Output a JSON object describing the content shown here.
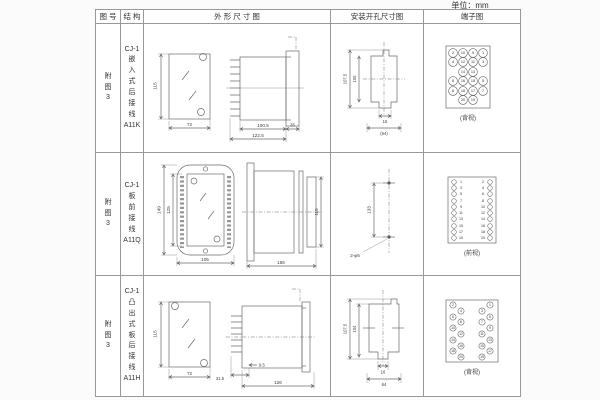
{
  "unit_label": "单位：mm",
  "headers": {
    "fig_no": "图 号",
    "structure": "结 构",
    "outline": "外 形 尺 寸 图",
    "mounting": "安装开孔尺寸图",
    "terminal": "端子图"
  },
  "rows": [
    {
      "fig_no": "附\n图\n3",
      "structure": "CJ-1\n嵌\n入\n式\n后\n接\n线\nA11K",
      "outline": {
        "front_h": "115",
        "front_w": "72",
        "side_inner": "100.5",
        "side_total": "122.5",
        "side_flange": "35"
      },
      "mounting": {
        "outer": "107.5",
        "inner": "105",
        "slot": "16",
        "span": "(64)"
      },
      "terminal": {
        "view_label": "(背视)",
        "items": [
          [
            29,
            29,
            "2"
          ],
          [
            39,
            29,
            "10"
          ],
          [
            49,
            29,
            "9"
          ],
          [
            59,
            29,
            "1"
          ],
          [
            29,
            38,
            "4"
          ],
          [
            39,
            38,
            "12"
          ],
          [
            49,
            38,
            "11"
          ],
          [
            59,
            38,
            "3"
          ],
          [
            39,
            48,
            "14"
          ],
          [
            49,
            48,
            "13"
          ],
          [
            29,
            57,
            "6"
          ],
          [
            39,
            57,
            "16"
          ],
          [
            49,
            57,
            "15"
          ],
          [
            59,
            57,
            "5"
          ],
          [
            29,
            67,
            "8"
          ],
          [
            39,
            67,
            "18"
          ],
          [
            49,
            67,
            "17"
          ],
          [
            59,
            67,
            "7"
          ],
          [
            39,
            76,
            "20"
          ],
          [
            49,
            76,
            "19"
          ]
        ]
      }
    },
    {
      "fig_no": "附\n图\n3",
      "structure": "CJ-1\n板\n前\n接\n线\nA11Q",
      "outline": {
        "front_h_outer": "149",
        "front_h_inner": "125",
        "front_w": "105",
        "side_len": "156",
        "side_h": "115"
      },
      "mounting": {
        "span": "133",
        "holes": "2-φ6"
      },
      "terminal": {
        "view_label": "(前视)",
        "items": [
          [
            30,
            29,
            "",
            "o"
          ],
          [
            37,
            29,
            "1",
            "t"
          ],
          [
            59,
            29,
            "2",
            "t"
          ],
          [
            66,
            29,
            "",
            "o"
          ],
          [
            30,
            35,
            "",
            "o"
          ],
          [
            37,
            35,
            "3",
            "t"
          ],
          [
            59,
            35,
            "4",
            "t"
          ],
          [
            66,
            35,
            "",
            "o"
          ],
          [
            30,
            41,
            "",
            "o"
          ],
          [
            37,
            41,
            "5",
            "t"
          ],
          [
            59,
            41,
            "6",
            "t"
          ],
          [
            66,
            41,
            "",
            "o"
          ],
          [
            30,
            48,
            "",
            "o"
          ],
          [
            37,
            48,
            "7",
            "t"
          ],
          [
            59,
            48,
            "8",
            "t"
          ],
          [
            66,
            48,
            "",
            "o"
          ],
          [
            30,
            54,
            "",
            "o"
          ],
          [
            37,
            54,
            "9",
            "t"
          ],
          [
            59,
            54,
            "10",
            "t"
          ],
          [
            66,
            54,
            "",
            "o"
          ],
          [
            30,
            60,
            "",
            "o"
          ],
          [
            37,
            60,
            "11",
            "t"
          ],
          [
            59,
            60,
            "12",
            "t"
          ],
          [
            66,
            60,
            "",
            "o"
          ],
          [
            30,
            66,
            "",
            "o"
          ],
          [
            37,
            66,
            "13",
            "t"
          ],
          [
            59,
            66,
            "14",
            "t"
          ],
          [
            66,
            66,
            "",
            "o"
          ],
          [
            30,
            73,
            "",
            "o"
          ],
          [
            37,
            73,
            "15",
            "t"
          ],
          [
            59,
            73,
            "16",
            "t"
          ],
          [
            66,
            73,
            "",
            "o"
          ],
          [
            30,
            79,
            "",
            "o"
          ],
          [
            37,
            79,
            "17",
            "t"
          ],
          [
            59,
            79,
            "18",
            "t"
          ],
          [
            66,
            79,
            "",
            "o"
          ],
          [
            30,
            85,
            "",
            "o"
          ],
          [
            37,
            85,
            "19",
            "t"
          ],
          [
            59,
            85,
            "20",
            "t"
          ],
          [
            66,
            85,
            "",
            "o"
          ]
        ]
      }
    },
    {
      "fig_no": "附\n图\n3",
      "structure": "CJ-1\n凸\n出\n式\n板\n后\n接\n线\nA11H",
      "outline": {
        "front_h": "115",
        "front_w": "72",
        "fin_w": "31.5",
        "gap": "9.5",
        "side_len": "126"
      },
      "mounting": {
        "outer": "107.5",
        "inner": "104",
        "slot": "16",
        "span": "64"
      },
      "terminal": {
        "view_label": "(背视)",
        "items": [
          [
            29,
            29,
            "2"
          ],
          [
            66,
            29,
            "1"
          ],
          [
            37,
            35,
            "4"
          ],
          [
            58,
            35,
            "3"
          ],
          [
            29,
            41,
            "6"
          ],
          [
            66,
            41,
            "5"
          ],
          [
            37,
            46,
            "8"
          ],
          [
            58,
            46,
            "7"
          ],
          [
            29,
            52,
            "10"
          ],
          [
            66,
            52,
            "9"
          ],
          [
            37,
            58,
            "12"
          ],
          [
            58,
            58,
            "11"
          ],
          [
            29,
            64,
            "14"
          ],
          [
            66,
            64,
            "13"
          ],
          [
            37,
            70,
            "16"
          ],
          [
            58,
            70,
            "15"
          ],
          [
            29,
            75,
            "18"
          ],
          [
            66,
            75,
            "17"
          ],
          [
            37,
            81,
            "20"
          ],
          [
            58,
            81,
            "19"
          ]
        ]
      }
    }
  ]
}
